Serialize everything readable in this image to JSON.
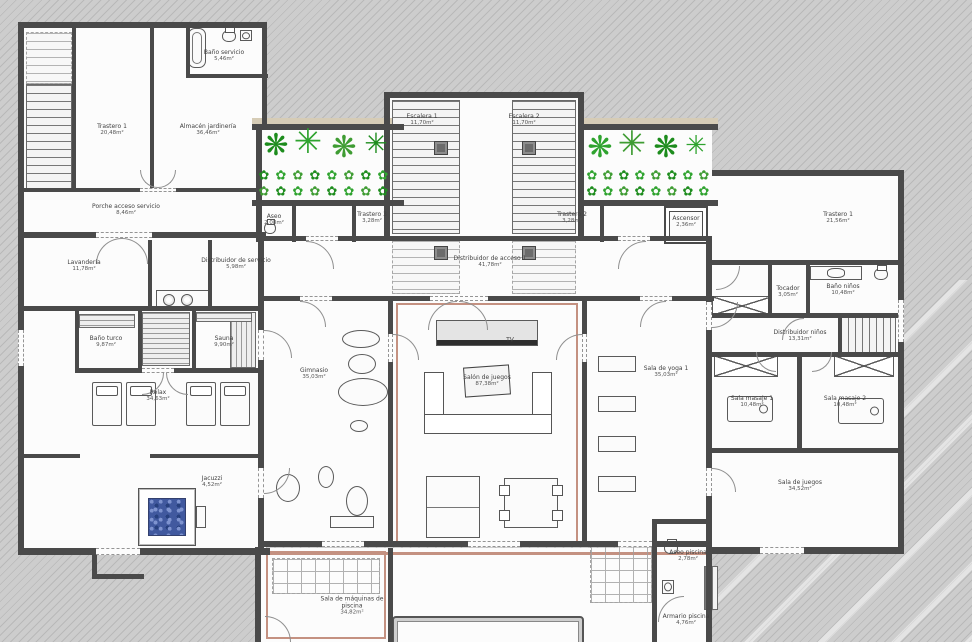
{
  "plan": {
    "type": "architectural floor plan - basement spa level",
    "palette": {
      "background": "#c9c9c9",
      "hatch": "#b9b9b9",
      "floor": "#fcfcfc",
      "wall": "#4a4a4a",
      "accent": "#c49181",
      "beige": "#d6ccb6",
      "water": "#41599f",
      "plant_greens": [
        "#1d8c1d",
        "#2fa32f",
        "#3f9c33"
      ]
    }
  },
  "rooms": [
    {
      "label": "Trastero 1",
      "area": "20,48m²",
      "x": 112,
      "y": 130
    },
    {
      "label": "Almacén jardinería",
      "area": "36,46m²",
      "x": 208,
      "y": 130
    },
    {
      "label": "Baño servicio",
      "area": "5,46m²",
      "x": 224,
      "y": 56
    },
    {
      "label": "Porche acceso servicio",
      "area": "8,46m²",
      "x": 126,
      "y": 210
    },
    {
      "label": "Lavandería",
      "area": "11,78m²",
      "x": 84,
      "y": 266
    },
    {
      "label": "Distribuidor de servicio",
      "area": "5,98m²",
      "x": 236,
      "y": 264
    },
    {
      "label": "Aseo",
      "area": "2,08m²",
      "x": 274,
      "y": 220
    },
    {
      "label": "Trastero 3",
      "area": "3,28m²",
      "x": 372,
      "y": 218
    },
    {
      "label": "Trastero 2",
      "area": "3,28m²",
      "x": 572,
      "y": 218
    },
    {
      "label": "Ascensor",
      "area": "2,36m²",
      "x": 686,
      "y": 222
    },
    {
      "label": "Escalera 1",
      "area": "11,70m²",
      "x": 422,
      "y": 120
    },
    {
      "label": "Escalera 2",
      "area": "11,70m²",
      "x": 524,
      "y": 120
    },
    {
      "label": "Distribuidor de acceso 1",
      "area": "41,78m²",
      "x": 490,
      "y": 262
    },
    {
      "label": "Baño turco",
      "area": "9,87m²",
      "x": 106,
      "y": 342
    },
    {
      "label": "Sauna",
      "area": "9,90m²",
      "x": 224,
      "y": 342
    },
    {
      "label": "Relax",
      "area": "34,63m²",
      "x": 158,
      "y": 396
    },
    {
      "label": "Gimnasio",
      "area": "35,03m²",
      "x": 314,
      "y": 374
    },
    {
      "label": "Salón de juegos",
      "area": "87,38m²",
      "x": 487,
      "y": 381
    },
    {
      "label": "Jacuzzi",
      "area": "4,52m²",
      "x": 212,
      "y": 482
    },
    {
      "label": "Sala de yoga 1",
      "area": "35,03m²",
      "x": 666,
      "y": 372
    },
    {
      "label": "Trastero 1",
      "area": "21,56m²",
      "x": 838,
      "y": 218
    },
    {
      "label": "Tocador",
      "area": "3,05m²",
      "x": 788,
      "y": 292
    },
    {
      "label": "Baño niños",
      "area": "10,48m²",
      "x": 843,
      "y": 290
    },
    {
      "label": "Distribuidor niños",
      "area": "13,31m²",
      "x": 800,
      "y": 336
    },
    {
      "label": "Sala masaje 1",
      "area": "10,48m²",
      "x": 752,
      "y": 402
    },
    {
      "label": "Sala masaje 2",
      "area": "10,48m²",
      "x": 845,
      "y": 402
    },
    {
      "label": "Sala de juegos",
      "area": "34,52m²",
      "x": 800,
      "y": 486
    },
    {
      "label": "Sala de máquinas de piscina",
      "area": "34,82m²",
      "x": 352,
      "y": 606
    },
    {
      "label": "Aseo piscina",
      "area": "2,78m²",
      "x": 688,
      "y": 556
    },
    {
      "label": "Armario piscina",
      "area": "4,76m²",
      "x": 686,
      "y": 620
    },
    {
      "label": "TV",
      "area": "",
      "x": 510,
      "y": 340
    }
  ],
  "geometry": {
    "floors": [
      [
        18,
        22,
        248,
        216
      ],
      [
        18,
        234,
        248,
        320
      ],
      [
        256,
        124,
        146,
        82
      ],
      [
        384,
        92,
        200,
        148
      ],
      [
        578,
        124,
        134,
        82
      ],
      [
        262,
        205,
        450,
        342
      ],
      [
        712,
        176,
        190,
        372
      ],
      [
        258,
        548,
        454,
        94
      ],
      [
        652,
        521,
        60,
        28
      ]
    ],
    "beige": [
      [
        252,
        118,
        152,
        6
      ],
      [
        578,
        118,
        140,
        6
      ]
    ],
    "walls": [
      [
        18,
        22,
        248,
        6
      ],
      [
        18,
        22,
        6,
        532
      ],
      [
        18,
        548,
        252,
        7
      ],
      [
        262,
        22,
        5,
        108
      ],
      [
        252,
        124,
        152,
        6
      ],
      [
        384,
        92,
        6,
        148
      ],
      [
        384,
        92,
        200,
        6
      ],
      [
        578,
        92,
        6,
        148
      ],
      [
        578,
        124,
        140,
        6
      ],
      [
        712,
        170,
        192,
        6
      ],
      [
        898,
        170,
        6,
        384
      ],
      [
        712,
        547,
        190,
        7
      ],
      [
        256,
        124,
        6,
        118
      ],
      [
        258,
        240,
        6,
        314
      ],
      [
        706,
        240,
        6,
        308
      ],
      [
        258,
        541,
        454,
        6
      ],
      [
        255,
        547,
        6,
        95
      ],
      [
        706,
        519,
        6,
        123
      ],
      [
        652,
        519,
        56,
        5
      ],
      [
        652,
        519,
        5,
        123
      ],
      [
        252,
        200,
        152,
        6
      ],
      [
        578,
        200,
        140,
        6
      ],
      [
        292,
        206,
        4,
        36
      ],
      [
        352,
        206,
        4,
        36
      ],
      [
        600,
        206,
        4,
        36
      ],
      [
        258,
        236,
        454,
        5
      ],
      [
        18,
        232,
        248,
        6
      ],
      [
        22,
        188,
        240,
        4
      ],
      [
        186,
        22,
        4,
        56
      ],
      [
        186,
        74,
        82,
        4
      ],
      [
        72,
        26,
        4,
        164
      ],
      [
        150,
        26,
        4,
        164
      ],
      [
        148,
        240,
        4,
        70
      ],
      [
        208,
        240,
        4,
        70
      ],
      [
        18,
        306,
        244,
        5
      ],
      [
        75,
        310,
        4,
        62
      ],
      [
        138,
        310,
        4,
        62
      ],
      [
        192,
        310,
        4,
        62
      ],
      [
        75,
        368,
        184,
        5
      ],
      [
        18,
        454,
        62,
        4
      ],
      [
        150,
        454,
        110,
        4
      ],
      [
        262,
        296,
        452,
        5
      ],
      [
        388,
        300,
        5,
        246
      ],
      [
        582,
        300,
        5,
        246
      ],
      [
        712,
        260,
        188,
        5
      ],
      [
        712,
        313,
        188,
        5
      ],
      [
        712,
        352,
        188,
        5
      ],
      [
        712,
        448,
        188,
        5
      ],
      [
        797,
        355,
        5,
        95
      ],
      [
        768,
        264,
        4,
        52
      ],
      [
        806,
        264,
        4,
        52
      ],
      [
        388,
        548,
        5,
        94
      ],
      [
        92,
        548,
        5,
        30
      ],
      [
        92,
        574,
        52,
        5
      ],
      [
        838,
        313,
        60,
        4
      ],
      [
        838,
        313,
        4,
        44
      ],
      [
        838,
        353,
        60,
        4
      ]
    ],
    "accents": [
      {
        "k": "o",
        "r": [
          396,
          303,
          182,
          240
        ]
      },
      {
        "k": "f",
        "r": [
          264,
          552,
          444,
          3
        ]
      },
      {
        "k": "o",
        "r": [
          266,
          551,
          120,
          88
        ]
      }
    ],
    "gaps": [
      [
        140,
        188,
        36,
        4
      ],
      [
        96,
        232,
        56,
        6
      ],
      [
        306,
        236,
        32,
        5
      ],
      [
        618,
        236,
        32,
        5
      ],
      [
        300,
        296,
        32,
        5
      ],
      [
        430,
        296,
        58,
        5
      ],
      [
        640,
        296,
        32,
        5
      ],
      [
        322,
        541,
        42,
        6
      ],
      [
        468,
        541,
        52,
        6
      ],
      [
        618,
        541,
        34,
        6
      ],
      [
        760,
        547,
        44,
        7
      ],
      [
        96,
        548,
        44,
        7
      ],
      [
        898,
        300,
        6,
        42
      ],
      [
        258,
        330,
        6,
        30
      ],
      [
        258,
        468,
        6,
        30
      ],
      [
        706,
        302,
        6,
        28
      ],
      [
        706,
        468,
        6,
        28
      ],
      [
        388,
        334,
        5,
        28
      ],
      [
        582,
        334,
        5,
        28
      ],
      [
        18,
        330,
        6,
        36
      ],
      [
        142,
        368,
        32,
        5
      ]
    ],
    "arcs": [
      [
        140,
        170,
        18,
        "bl"
      ],
      [
        158,
        170,
        18,
        "br"
      ],
      [
        96,
        238,
        26,
        "tl"
      ],
      [
        122,
        238,
        26,
        "tr"
      ],
      [
        306,
        241,
        28,
        "tr"
      ],
      [
        618,
        241,
        28,
        "tl"
      ],
      [
        428,
        301,
        29,
        "tl"
      ],
      [
        459,
        301,
        29,
        "tr"
      ],
      [
        300,
        301,
        26,
        "tr"
      ],
      [
        640,
        301,
        26,
        "tl"
      ],
      [
        264,
        330,
        28,
        "tr"
      ],
      [
        264,
        468,
        26,
        "br"
      ],
      [
        712,
        302,
        26,
        "br"
      ],
      [
        712,
        468,
        24,
        "tr"
      ],
      [
        393,
        334,
        26,
        "tr"
      ],
      [
        556,
        334,
        26,
        "tl"
      ],
      [
        716,
        266,
        24,
        "br"
      ],
      [
        756,
        352,
        20,
        "bl"
      ],
      [
        812,
        352,
        20,
        "br"
      ],
      [
        782,
        318,
        22,
        "tl"
      ],
      [
        658,
        596,
        26,
        "tl"
      ],
      [
        265,
        616,
        26,
        "tr"
      ],
      [
        142,
        373,
        22,
        "br"
      ],
      [
        166,
        373,
        22,
        "bl"
      ]
    ],
    "items": [
      [
        "stairsd",
        26,
        32,
        46,
        52
      ],
      [
        "stairs",
        26,
        84,
        46,
        106
      ],
      [
        "stairs",
        392,
        100,
        68,
        134
      ],
      [
        "stairs",
        512,
        100,
        64,
        134
      ],
      [
        "stairsd",
        392,
        240,
        68,
        54
      ],
      [
        "stairsd",
        512,
        240,
        64,
        54
      ],
      [
        "stairsv",
        840,
        316,
        56,
        40
      ],
      [
        "stairsv",
        704,
        566,
        14,
        44
      ],
      [
        "jacuzzi",
        138,
        488,
        58,
        58
      ],
      [
        "rect",
        196,
        506,
        10,
        22
      ],
      [
        "lounger",
        92,
        382,
        30,
        44
      ],
      [
        "lounger",
        126,
        382,
        30,
        44
      ],
      [
        "lounger",
        186,
        382,
        30,
        44
      ],
      [
        "lounger",
        220,
        382,
        30,
        44
      ],
      [
        "cook",
        156,
        290,
        54,
        18
      ],
      [
        "stripesh",
        79,
        314,
        56,
        14
      ],
      [
        "stripesh",
        142,
        312,
        48,
        54
      ],
      [
        "stripesv",
        230,
        312,
        26,
        56
      ],
      [
        "stripesh",
        196,
        312,
        56,
        10
      ],
      [
        "tub",
        188,
        28,
        18,
        40
      ],
      [
        "wc",
        222,
        30,
        14,
        12
      ],
      [
        "sink",
        240,
        30,
        12,
        11
      ],
      [
        "wc",
        264,
        222,
        12,
        12
      ],
      [
        "vanity",
        810,
        266,
        52,
        14
      ],
      [
        "wc",
        874,
        268,
        14,
        12
      ],
      [
        "wc",
        664,
        542,
        14,
        12
      ],
      [
        "sink",
        662,
        580,
        12,
        14
      ],
      [
        "massage",
        727,
        396,
        46,
        26
      ],
      [
        "massage",
        838,
        398,
        46,
        26
      ],
      [
        "mat",
        598,
        356,
        38,
        16
      ],
      [
        "mat",
        598,
        396,
        38,
        16
      ],
      [
        "mat",
        598,
        436,
        38,
        16
      ],
      [
        "mat",
        598,
        476,
        38,
        16
      ],
      [
        "usofa",
        424,
        372,
        128,
        62
      ],
      [
        "tv",
        436,
        320,
        102,
        26
      ],
      [
        "plate",
        464,
        366,
        46,
        30
      ],
      [
        "pooltab",
        426,
        476,
        54,
        62
      ],
      [
        "dining",
        504,
        478,
        54,
        50
      ],
      [
        "ell",
        342,
        330,
        38,
        18
      ],
      [
        "ell",
        348,
        354,
        28,
        20
      ],
      [
        "ell",
        338,
        378,
        50,
        28
      ],
      [
        "ell",
        350,
        420,
        18,
        12
      ],
      [
        "ell",
        276,
        474,
        24,
        28
      ],
      [
        "ell",
        318,
        466,
        16,
        22
      ],
      [
        "ell",
        346,
        486,
        22,
        30
      ],
      [
        "rect",
        330,
        516,
        44,
        12
      ],
      [
        "xbox",
        712,
        296,
        60,
        20
      ],
      [
        "xbox",
        714,
        355,
        64,
        22
      ],
      [
        "xbox",
        834,
        355,
        60,
        22
      ],
      [
        "pillar",
        434,
        141,
        14,
        14
      ],
      [
        "pillar",
        522,
        141,
        14,
        14
      ],
      [
        "pillar",
        434,
        246,
        14,
        14
      ],
      [
        "pillar",
        522,
        246,
        14,
        14
      ],
      [
        "box2",
        664,
        206,
        44,
        38
      ],
      [
        "dashgrid",
        272,
        558,
        108,
        36
      ],
      [
        "dashgrid",
        590,
        545,
        62,
        58
      ],
      [
        "pool",
        392,
        616,
        192,
        56
      ]
    ]
  },
  "plants": {
    "glyphs": [
      "✳",
      "❋",
      "✿"
    ],
    "colors": [
      "#1d8c1d",
      "#2fa32f",
      "#3f9c33"
    ],
    "list": [
      [
        276,
        146,
        30,
        1,
        0
      ],
      [
        308,
        142,
        34,
        0,
        1
      ],
      [
        344,
        148,
        30,
        1,
        2
      ],
      [
        376,
        144,
        28,
        0,
        0
      ],
      [
        600,
        148,
        30,
        1,
        1
      ],
      [
        632,
        144,
        34,
        0,
        2
      ],
      [
        666,
        148,
        30,
        1,
        0
      ],
      [
        696,
        146,
        26,
        0,
        1
      ],
      [
        264,
        176,
        13,
        2,
        0
      ],
      [
        281,
        176,
        13,
        2,
        1
      ],
      [
        298,
        176,
        13,
        2,
        2
      ],
      [
        315,
        176,
        13,
        2,
        0
      ],
      [
        332,
        176,
        13,
        2,
        1
      ],
      [
        349,
        176,
        13,
        2,
        2
      ],
      [
        366,
        176,
        13,
        2,
        0
      ],
      [
        383,
        176,
        13,
        2,
        1
      ],
      [
        264,
        192,
        13,
        2,
        2
      ],
      [
        281,
        192,
        13,
        2,
        0
      ],
      [
        298,
        192,
        13,
        2,
        1
      ],
      [
        315,
        192,
        13,
        2,
        2
      ],
      [
        332,
        192,
        13,
        2,
        0
      ],
      [
        349,
        192,
        13,
        2,
        1
      ],
      [
        366,
        192,
        13,
        2,
        2
      ],
      [
        383,
        192,
        13,
        2,
        0
      ],
      [
        592,
        176,
        13,
        2,
        1
      ],
      [
        608,
        176,
        13,
        2,
        2
      ],
      [
        624,
        176,
        13,
        2,
        0
      ],
      [
        640,
        176,
        13,
        2,
        1
      ],
      [
        656,
        176,
        13,
        2,
        2
      ],
      [
        672,
        176,
        13,
        2,
        0
      ],
      [
        688,
        176,
        13,
        2,
        1
      ],
      [
        704,
        176,
        13,
        2,
        2
      ],
      [
        592,
        192,
        13,
        2,
        0
      ],
      [
        608,
        192,
        13,
        2,
        1
      ],
      [
        624,
        192,
        13,
        2,
        2
      ],
      [
        640,
        192,
        13,
        2,
        0
      ],
      [
        656,
        192,
        13,
        2,
        1
      ],
      [
        672,
        192,
        13,
        2,
        2
      ],
      [
        688,
        192,
        13,
        2,
        0
      ],
      [
        704,
        192,
        13,
        2,
        1
      ]
    ]
  }
}
